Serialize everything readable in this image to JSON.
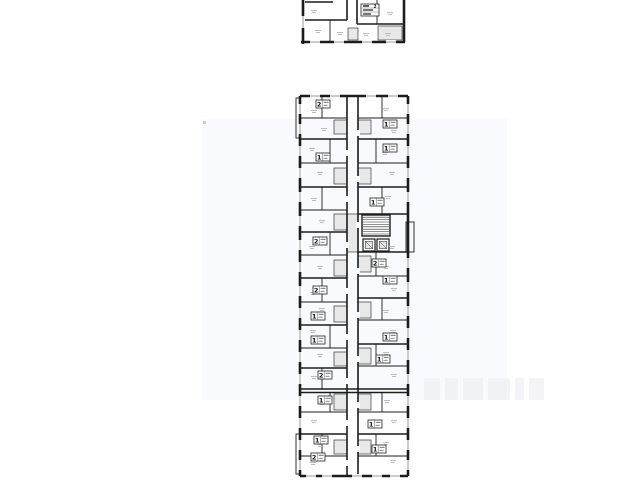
{
  "meta": {
    "background": "#ffffff",
    "wall_color": "#1c1c1c",
    "gray_fill": "#e8e8e8",
    "window_color": "#8f8f8f",
    "mark_color": "#b5b5b5",
    "badge_border": "#222222",
    "badge_text_color": "#111111"
  },
  "watermark": {
    "tint_color": "#edf2f9",
    "tint_opacity": 0.38,
    "x": 202,
    "y": 119,
    "width": 305,
    "height": 281,
    "dot": {
      "x": 203,
      "y": 121,
      "size": 3,
      "color": "#b0b0b0"
    },
    "glyph_row": {
      "x": 424,
      "y": 378,
      "height": 22,
      "color": "#ebebef",
      "glyph_widths": [
        16,
        13,
        20,
        22,
        9,
        15
      ],
      "gap": 5
    }
  },
  "plans": [
    {
      "name": "upper-floor-plan-fragment",
      "walls": [
        [
          303,
          0,
          303,
          44,
          3
        ],
        [
          301,
          42,
          405,
          42,
          3
        ],
        [
          404,
          0,
          404,
          42,
          3
        ],
        [
          347,
          0,
          347,
          20,
          2
        ],
        [
          357,
          0,
          357,
          24,
          2
        ],
        [
          377,
          0,
          377,
          24,
          1
        ],
        [
          303,
          20,
          347,
          20,
          2
        ],
        [
          330,
          20,
          330,
          42,
          1
        ],
        [
          357,
          24,
          404,
          24,
          2
        ],
        [
          305,
          2,
          333,
          2,
          2
        ]
      ],
      "rects": [],
      "gray_rooms": [
        [
          378,
          26,
          24,
          14
        ],
        [
          348,
          28,
          10,
          12
        ]
      ],
      "windows_v": [
        [
          303,
          16,
          28
        ]
      ],
      "windows_h": [
        [
          42,
          310,
          320
        ],
        [
          42,
          334,
          344
        ],
        [
          42,
          362,
          372
        ],
        [
          42,
          386,
          396
        ]
      ],
      "gaps": [],
      "badges": [
        [
          361,
          4,
          "2",
          "lg"
        ]
      ],
      "marks": [
        [
          314,
          10
        ],
        [
          318,
          30
        ],
        [
          340,
          32
        ],
        [
          366,
          33
        ],
        [
          390,
          12
        ],
        [
          388,
          33
        ]
      ]
    },
    {
      "name": "main-floor-plan",
      "walls": [
        [
          300,
          96,
          300,
          476,
          3
        ],
        [
          300,
          96,
          408,
          96,
          3
        ],
        [
          408,
          96,
          408,
          476,
          3
        ],
        [
          300,
          476,
          408,
          476,
          3
        ],
        [
          347,
          96,
          347,
          476,
          2
        ],
        [
          358,
          96,
          358,
          476,
          2
        ],
        [
          300,
          139,
          347,
          139,
          2
        ],
        [
          300,
          187,
          347,
          187,
          2
        ],
        [
          300,
          232,
          347,
          232,
          2
        ],
        [
          300,
          278,
          347,
          278,
          2
        ],
        [
          300,
          325,
          347,
          325,
          2
        ],
        [
          300,
          368,
          347,
          368,
          2
        ],
        [
          300,
          434,
          347,
          434,
          2
        ],
        [
          300,
          389,
          408,
          389,
          2
        ],
        [
          300,
          392.5,
          408,
          392.5,
          2
        ],
        [
          300,
          118,
          347,
          118,
          1
        ],
        [
          300,
          163,
          347,
          163,
          1
        ],
        [
          300,
          210,
          347,
          210,
          1
        ],
        [
          300,
          255,
          347,
          255,
          1
        ],
        [
          300,
          302,
          347,
          302,
          1
        ],
        [
          300,
          348,
          347,
          348,
          1
        ],
        [
          300,
          412,
          347,
          412,
          1
        ],
        [
          300,
          456,
          347,
          456,
          1
        ],
        [
          358,
          139,
          408,
          139,
          2
        ],
        [
          358,
          187,
          408,
          187,
          2
        ],
        [
          358,
          214,
          408,
          214,
          2
        ],
        [
          358,
          252,
          408,
          252,
          2
        ],
        [
          358,
          298,
          408,
          298,
          2
        ],
        [
          358,
          344,
          408,
          344,
          2
        ],
        [
          358,
          434,
          408,
          434,
          2
        ],
        [
          358,
          118,
          408,
          118,
          1
        ],
        [
          358,
          163,
          408,
          163,
          1
        ],
        [
          358,
          276,
          408,
          276,
          1
        ],
        [
          358,
          320,
          408,
          320,
          1
        ],
        [
          358,
          366,
          408,
          366,
          1
        ],
        [
          358,
          412,
          408,
          412,
          1
        ],
        [
          358,
          456,
          408,
          456,
          1
        ],
        [
          322,
          96,
          322,
          118,
          1
        ],
        [
          330,
          139,
          330,
          163,
          1
        ],
        [
          322,
          187,
          322,
          210,
          1
        ],
        [
          330,
          232,
          330,
          255,
          1
        ],
        [
          322,
          278,
          322,
          302,
          1
        ],
        [
          330,
          325,
          330,
          348,
          1
        ],
        [
          322,
          368,
          322,
          389,
          1
        ],
        [
          330,
          392.5,
          330,
          412,
          1
        ],
        [
          322,
          434,
          322,
          456,
          1
        ],
        [
          382,
          96,
          382,
          118,
          1
        ],
        [
          376,
          139,
          376,
          163,
          1
        ],
        [
          382,
          187,
          382,
          214,
          1
        ],
        [
          376,
          252,
          376,
          276,
          1
        ],
        [
          382,
          298,
          382,
          320,
          1
        ],
        [
          376,
          344,
          376,
          366,
          1
        ],
        [
          382,
          392.5,
          382,
          412,
          1
        ],
        [
          376,
          434,
          376,
          456,
          1
        ],
        [
          376,
          215,
          376,
          236,
          1
        ]
      ],
      "rects": [
        [
          406,
          222,
          8,
          30,
          1
        ],
        [
          296,
          98,
          4,
          40,
          1
        ],
        [
          296,
          434,
          4,
          40,
          1
        ]
      ],
      "gray_rooms": [
        [
          334,
          120,
          13,
          14
        ],
        [
          334,
          168,
          13,
          16
        ],
        [
          334,
          214,
          13,
          16
        ],
        [
          334,
          260,
          13,
          16
        ],
        [
          334,
          306,
          13,
          16
        ],
        [
          334,
          352,
          13,
          14
        ],
        [
          334,
          394,
          13,
          16
        ],
        [
          334,
          440,
          13,
          14
        ],
        [
          358,
          120,
          13,
          14
        ],
        [
          358,
          168,
          13,
          16
        ],
        [
          358,
          256,
          13,
          16
        ],
        [
          358,
          302,
          13,
          16
        ],
        [
          358,
          348,
          13,
          16
        ],
        [
          358,
          394,
          13,
          16
        ],
        [
          358,
          440,
          13,
          14
        ],
        [
          347,
          214,
          11,
          38
        ]
      ],
      "stairs": {
        "x": 362,
        "y": 215,
        "w": 28,
        "h": 21
      },
      "elevators": [
        [
          363,
          239,
          12,
          12
        ],
        [
          377,
          239,
          12,
          12
        ]
      ],
      "windows_v": [
        [
          300,
          104,
          114
        ],
        [
          300,
          124,
          134
        ],
        [
          300,
          146,
          156
        ],
        [
          300,
          168,
          178
        ],
        [
          300,
          192,
          202
        ],
        [
          300,
          216,
          226
        ],
        [
          300,
          240,
          250
        ],
        [
          300,
          262,
          272
        ],
        [
          300,
          286,
          296
        ],
        [
          300,
          308,
          318
        ],
        [
          300,
          330,
          340
        ],
        [
          300,
          352,
          362
        ],
        [
          300,
          374,
          384
        ],
        [
          300,
          396,
          406
        ],
        [
          300,
          418,
          428
        ],
        [
          300,
          440,
          450
        ],
        [
          300,
          460,
          470
        ],
        [
          408,
          104,
          114
        ],
        [
          408,
          124,
          134
        ],
        [
          408,
          146,
          156
        ],
        [
          408,
          168,
          178
        ],
        [
          408,
          192,
          202
        ],
        [
          408,
          258,
          268
        ],
        [
          408,
          282,
          292
        ],
        [
          408,
          306,
          316
        ],
        [
          408,
          328,
          338
        ],
        [
          408,
          350,
          360
        ],
        [
          408,
          374,
          384
        ],
        [
          408,
          396,
          406
        ],
        [
          408,
          418,
          428
        ],
        [
          408,
          440,
          450
        ],
        [
          408,
          460,
          470
        ]
      ],
      "windows_h": [
        [
          96,
          310,
          320
        ],
        [
          96,
          330,
          340
        ],
        [
          96,
          366,
          376
        ],
        [
          96,
          388,
          398
        ],
        [
          476,
          306,
          316
        ],
        [
          476,
          322,
          332
        ],
        [
          476,
          352,
          362
        ],
        [
          476,
          372,
          382
        ],
        [
          476,
          390,
          400
        ]
      ],
      "gaps": [
        [
          347,
          150
        ],
        [
          347,
          196
        ],
        [
          347,
          242
        ],
        [
          347,
          288
        ],
        [
          347,
          334
        ],
        [
          347,
          378
        ],
        [
          347,
          420
        ],
        [
          347,
          460
        ],
        [
          358,
          130
        ],
        [
          358,
          176
        ],
        [
          358,
          222
        ],
        [
          358,
          268
        ],
        [
          358,
          312
        ],
        [
          358,
          356
        ],
        [
          358,
          402
        ],
        [
          358,
          446
        ]
      ],
      "badges": [
        [
          316,
          100,
          "2"
        ],
        [
          316,
          153,
          "1"
        ],
        [
          313,
          237,
          "2"
        ],
        [
          313,
          286,
          "2"
        ],
        [
          311,
          312,
          "1"
        ],
        [
          311,
          336,
          "1"
        ],
        [
          318,
          371,
          "2"
        ],
        [
          318,
          396,
          "1"
        ],
        [
          314,
          436,
          "1"
        ],
        [
          311,
          453,
          "2"
        ],
        [
          383,
          120,
          "1"
        ],
        [
          383,
          144,
          "1"
        ],
        [
          370,
          198,
          "1"
        ],
        [
          372,
          259,
          "2"
        ],
        [
          383,
          276,
          "1"
        ],
        [
          383,
          333,
          "1"
        ],
        [
          376,
          355,
          "1"
        ],
        [
          368,
          420,
          "1"
        ],
        [
          372,
          445,
          "1"
        ]
      ],
      "marks": [
        [
          314,
          110
        ],
        [
          324,
          128
        ],
        [
          312,
          148
        ],
        [
          320,
          172
        ],
        [
          314,
          198
        ],
        [
          322,
          220
        ],
        [
          312,
          246
        ],
        [
          320,
          266
        ],
        [
          313,
          292
        ],
        [
          322,
          308
        ],
        [
          313,
          330
        ],
        [
          320,
          354
        ],
        [
          314,
          376
        ],
        [
          322,
          402
        ],
        [
          314,
          420
        ],
        [
          320,
          444
        ],
        [
          313,
          462
        ],
        [
          386,
          108
        ],
        [
          394,
          130
        ],
        [
          385,
          152
        ],
        [
          392,
          172
        ],
        [
          388,
          196
        ],
        [
          392,
          246
        ],
        [
          386,
          266
        ],
        [
          394,
          288
        ],
        [
          386,
          310
        ],
        [
          393,
          330
        ],
        [
          386,
          352
        ],
        [
          394,
          374
        ],
        [
          387,
          400
        ],
        [
          394,
          420
        ],
        [
          386,
          442
        ],
        [
          393,
          460
        ]
      ]
    }
  ]
}
